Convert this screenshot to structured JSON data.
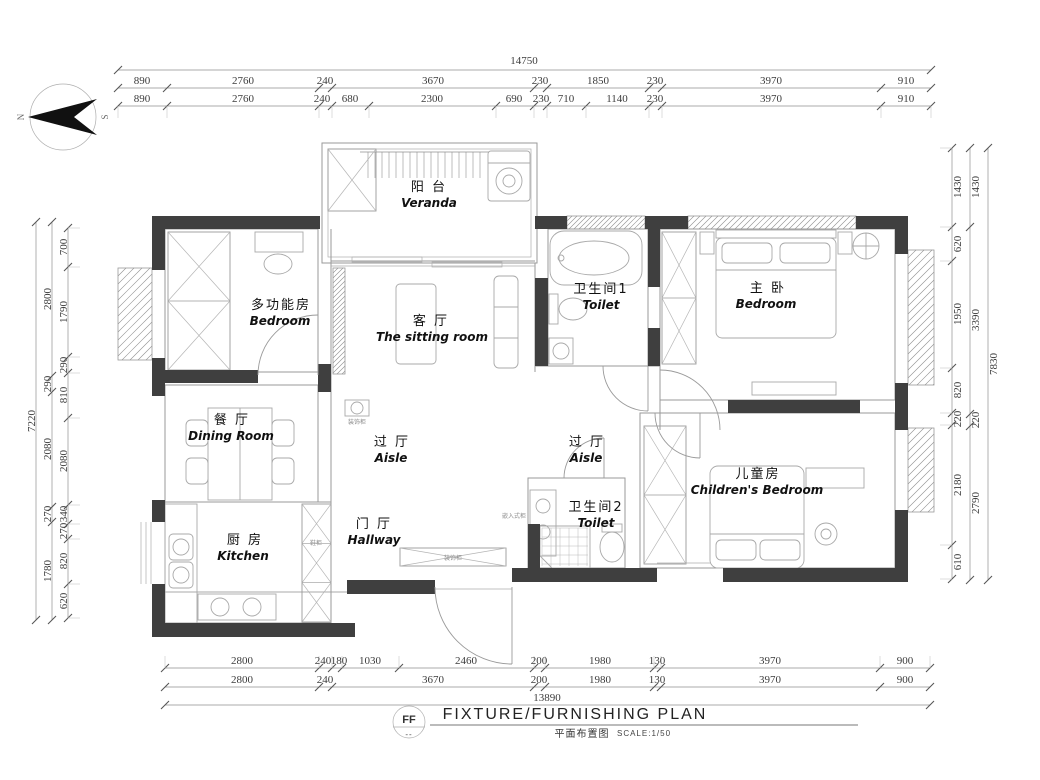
{
  "title_block": {
    "code": "FF",
    "code_sub": "--",
    "title_en": "FIXTURE/FURNISHING PLAN",
    "title_cn": "平面布置图",
    "scale": "SCALE:1/50"
  },
  "compass": {
    "north": "N",
    "south": "S"
  },
  "rooms": {
    "veranda": {
      "cn": "阳 台",
      "en": "Veranda"
    },
    "multi_bedroom": {
      "cn": "多功能房",
      "en": "Bedroom"
    },
    "sitting_room": {
      "cn": "客 厅",
      "en": "The sitting room"
    },
    "toilet1": {
      "cn": "卫生间1",
      "en": "Toilet"
    },
    "master_bedroom": {
      "cn": "主 卧",
      "en": "Bedroom"
    },
    "dining": {
      "cn": "餐 厅",
      "en": "Dining Room"
    },
    "aisle1": {
      "cn": "过 厅",
      "en": "Aisle"
    },
    "aisle2": {
      "cn": "过 厅",
      "en": "Aisle"
    },
    "children": {
      "cn": "儿童房",
      "en": "Children's Bedroom"
    },
    "kitchen": {
      "cn": "厨 房",
      "en": "Kitchen"
    },
    "hallway": {
      "cn": "门 厅",
      "en": "Hallway"
    },
    "toilet2": {
      "cn": "卫生间2",
      "en": "Toilet"
    }
  },
  "fixtures": {
    "deco_cabinet": "装饰柜",
    "shoe_cabinet": "鞋柜",
    "built_in_cabinet": "嵌入式柜",
    "deco_cabinet2": "装饰柜"
  },
  "dims": {
    "top": {
      "total": "14750",
      "row2": [
        "890",
        "2760",
        "240",
        "3670",
        "230",
        "1850",
        "230",
        "3970",
        "910"
      ],
      "row3": [
        "890",
        "2760",
        "240",
        "680",
        "2300",
        "690",
        "230",
        "710",
        "1140",
        "230",
        "3970",
        "910"
      ]
    },
    "bottom": {
      "row1": [
        "2800",
        "240",
        "180",
        "1030",
        "2460",
        "200",
        "1980",
        "130",
        "3970",
        "900"
      ],
      "row2": [
        "2800",
        "240",
        "3670",
        "200",
        "1980",
        "130",
        "3970",
        "900"
      ],
      "total": "13890"
    },
    "left": {
      "total": "7220",
      "middle": [
        "2800",
        "290",
        "2080",
        "270",
        "1780"
      ],
      "inner": [
        "700",
        "1790",
        "290",
        "810",
        "2080",
        "340",
        "270",
        "820",
        "620"
      ]
    },
    "right": {
      "total": "7830",
      "middle": [
        "1430",
        "3390",
        "220",
        "2790"
      ],
      "inner": [
        "1430",
        "620",
        "1950",
        "820",
        "220",
        "2180",
        "610"
      ]
    }
  }
}
